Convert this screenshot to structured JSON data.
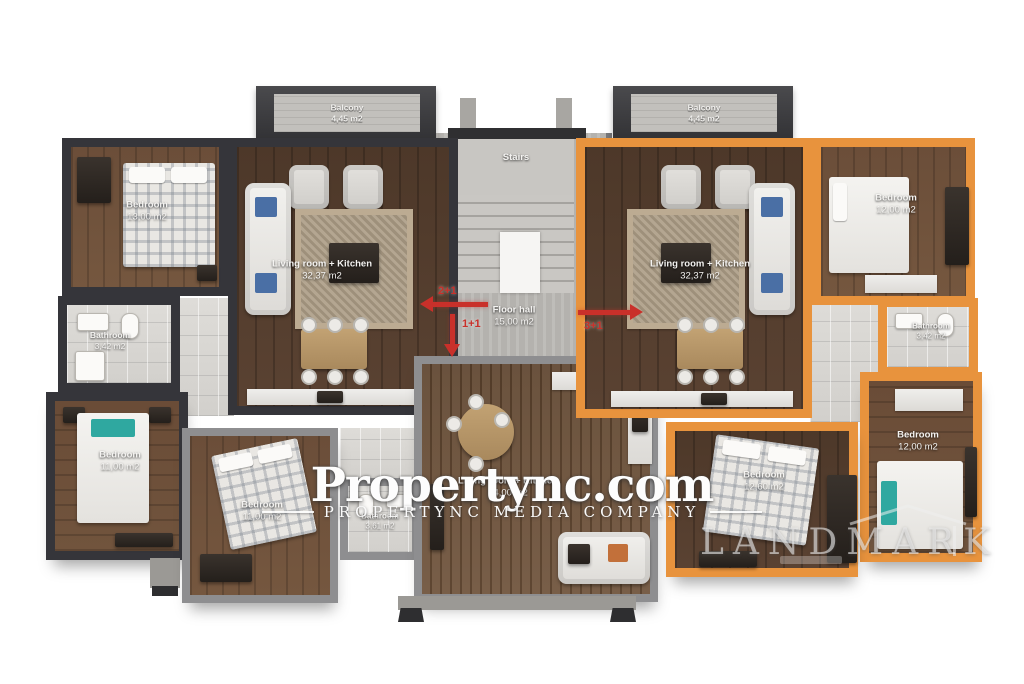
{
  "watermark": {
    "brand": "Propertync.com",
    "subtitle": "PROPERTYNC MEDIA COMPANY",
    "landmark": "LANDMARK"
  },
  "colors": {
    "left_unit_wall": "#35353a",
    "right_unit_wall": "#e8933d",
    "center_unit_wall": "#8e8e90",
    "arrow_red": "#c9302a"
  },
  "plan": {
    "stairs": {
      "label": "Stairs"
    },
    "floor_hall": {
      "name": "Floor hall",
      "area": "15,00 m2"
    },
    "arrows": [
      {
        "label": "2+1",
        "direction": "left"
      },
      {
        "label": "1+1",
        "direction": "down"
      },
      {
        "label": "3+1",
        "direction": "right"
      }
    ],
    "balconies": [
      {
        "name": "Balcony",
        "area": "4,45 m2"
      },
      {
        "name": "Balcony",
        "area": "4,45 m2"
      }
    ],
    "units": [
      {
        "type": "2+1",
        "rooms": [
          {
            "name": "Bedroom",
            "area": "13,00 m2"
          },
          {
            "name": "Living room + Kitchen",
            "area": "32,37 m2"
          },
          {
            "name": "Bathroom",
            "area": "3,42 m2"
          },
          {
            "name": "Bedroom",
            "area": "11,00 m2"
          }
        ]
      },
      {
        "type": "1+1",
        "rooms": [
          {
            "name": "Bedroom",
            "area": "11,00 m2"
          },
          {
            "name": "Bathroom",
            "area": "3,61 m2"
          },
          {
            "name": "Living room + Kitchen",
            "area": "24,00 m2"
          }
        ]
      },
      {
        "type": "3+1",
        "rooms": [
          {
            "name": "Living room + Kitchen",
            "area": "32,37 m2"
          },
          {
            "name": "Bedroom",
            "area": "12,00 m2"
          },
          {
            "name": "Bathroom",
            "area": "3,42 m2"
          },
          {
            "name": "Bedroom",
            "area": "12,00 m2"
          },
          {
            "name": "Bedroom",
            "area": "12,60 m2"
          }
        ]
      }
    ]
  }
}
